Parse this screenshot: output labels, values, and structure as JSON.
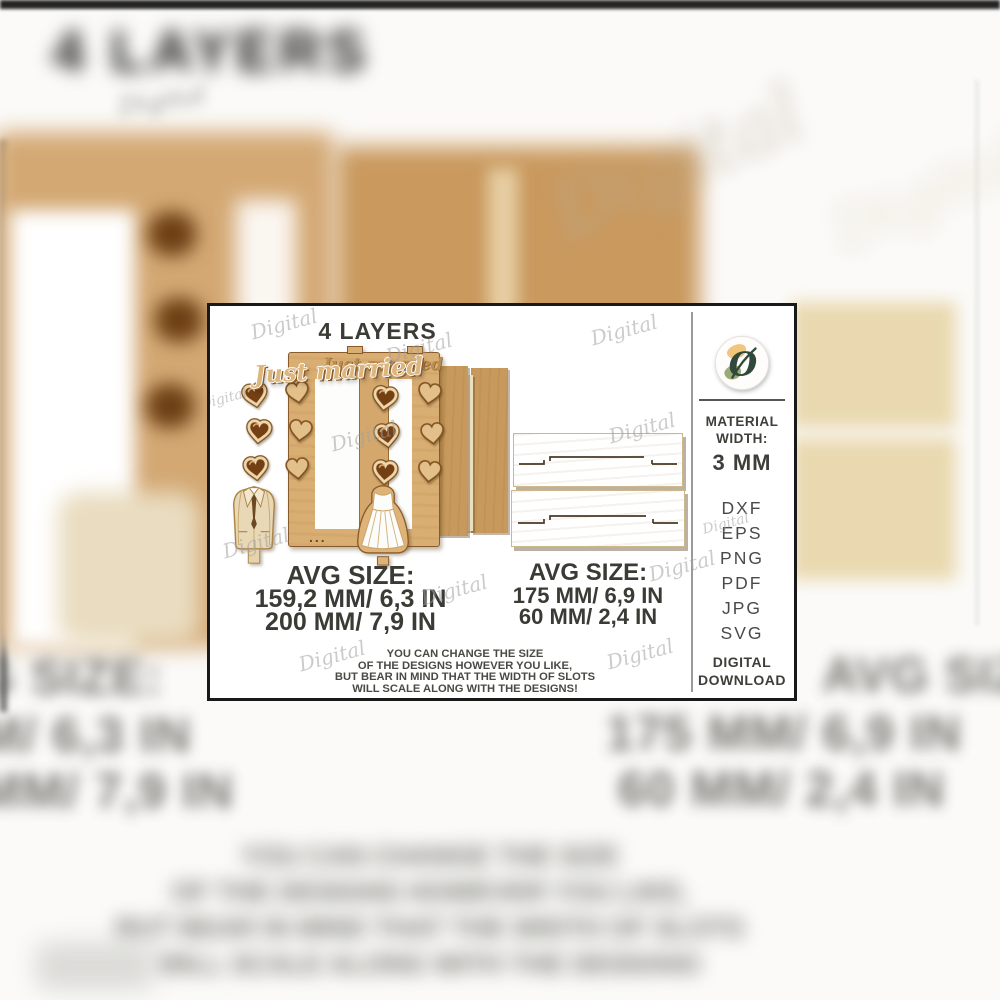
{
  "product_card": {
    "title": "4 LAYERS",
    "watermark_text": "Digital",
    "frame": {
      "script_text": "Just married",
      "dots": "..."
    },
    "size_left": {
      "label": "AVG SIZE:",
      "line1": "159,2 MM/ 6,3 IN",
      "line2": "200 MM/ 7,9 IN"
    },
    "size_right": {
      "label": "AVG SIZE:",
      "line1": "175 MM/ 6,9 IN",
      "line2": "60 MM/ 2,4 IN"
    },
    "note": {
      "line1": "YOU CAN CHANGE THE SIZE",
      "line2": "OF THE DESIGNS HOWEVER YOU LIKE,",
      "line3": "BUT BEAR IN MIND THAT THE WIDTH OF SLOTS",
      "line4": "WILL SCALE ALONG WITH THE DESIGNS!"
    },
    "sidebar": {
      "material_line1": "MATERIAL",
      "material_line2": "WIDTH:",
      "material_value": "3 MM",
      "formats": [
        "DXF",
        "EPS",
        "PNG",
        "PDF",
        "JPG",
        "SVG"
      ],
      "delivery_line1": "DIGITAL",
      "delivery_line2": "DOWNLOAD"
    },
    "colors": {
      "wood_light": "#d9ae72",
      "wood_medium": "#c8995c",
      "wood_cream": "#ecdfc0",
      "heart_brown": "#743f12",
      "text_dark": "#3c3c36",
      "watermark_gray": "#b5b5b5",
      "logo_green": "#30493a",
      "logo_orange": "#f2c57f"
    }
  }
}
